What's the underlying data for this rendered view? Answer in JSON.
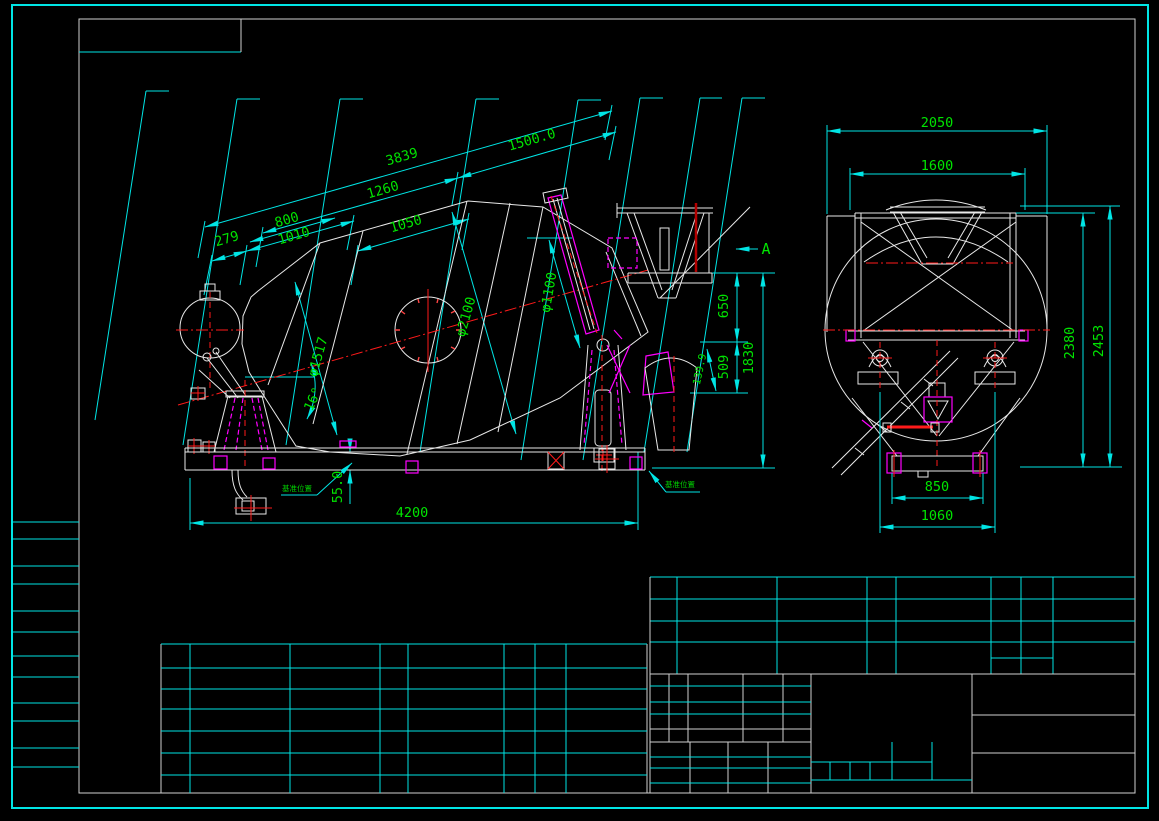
{
  "colors": {
    "background": "#000000",
    "border": "#00e5e5",
    "frame": "#cfcfcf",
    "geometry": "#ffffff",
    "dimension_text": "#00e400",
    "dimension_lines": "#00e5e5",
    "centerline": "#ff1a1a",
    "hidden_lines": "#ff00ff"
  },
  "side_view": {
    "view_arrow_label": "A",
    "datum_label_left": "基准位置",
    "datum_label_right": "基准位置",
    "dims": {
      "chain_279": "279",
      "chain_800": "800",
      "chain_1010": "1010",
      "chain_1050": "1050",
      "chain_1260": "1260",
      "chain_1500": "1500.0",
      "chain_3839": "3839",
      "dia_drum": "φ2100",
      "dia_opening": "φ1100",
      "dia_front_cone": "φ1517",
      "tilt_angle": "16°",
      "small_dim": "139.9",
      "v650": "650",
      "v509": "509",
      "v1830": "1830",
      "v55": "55.0",
      "h4200": "4200"
    }
  },
  "rear_view": {
    "dims": {
      "w2050": "2050",
      "w1600": "1600",
      "h2380": "2380",
      "h2453": "2453",
      "w850": "850",
      "w1060": "1060"
    }
  }
}
